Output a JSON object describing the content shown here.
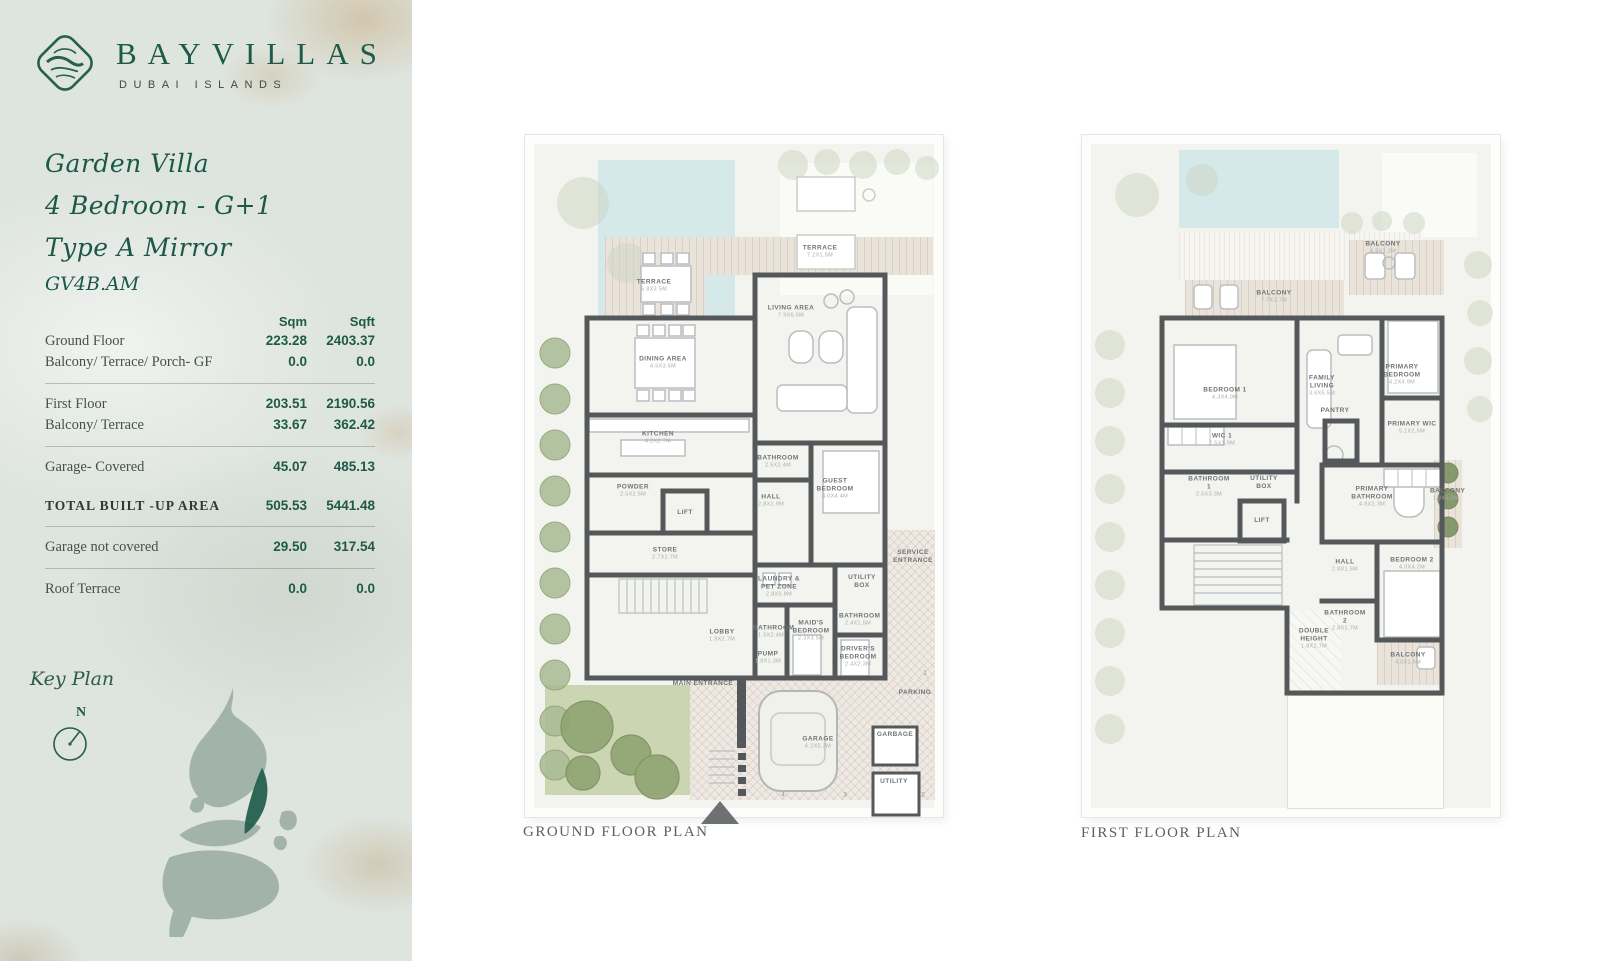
{
  "brand": {
    "name": "BAYVILLAS",
    "tagline": "DUBAI ISLANDS"
  },
  "unit": {
    "title_lines": [
      "Garden Villa",
      "4 Bedroom  -  G+1",
      "Type A Mirror"
    ],
    "code": "GV4B.AM"
  },
  "area_table": {
    "col_headers": [
      "Sqm",
      "Sqft"
    ],
    "rows": [
      {
        "label": "Ground Floor",
        "sqm": "223.28",
        "sqft": "2403.37"
      },
      {
        "label": "Balcony/ Terrace/ Porch- GF",
        "sqm": "0.0",
        "sqft": "0.0"
      },
      {
        "label": "First Floor",
        "sqm": "203.51",
        "sqft": "2190.56"
      },
      {
        "label": "Balcony/ Terrace",
        "sqm": "33.67",
        "sqft": "362.42"
      },
      {
        "label": "Garage- Covered",
        "sqm": "45.07",
        "sqft": "485.13"
      },
      {
        "label": "TOTAL BUILT -UP AREA",
        "sqm": "505.53",
        "sqft": "5441.48"
      },
      {
        "label": "Garage not covered",
        "sqm": "29.50",
        "sqft": "317.54"
      },
      {
        "label": "Roof Terrace",
        "sqm": "0.0",
        "sqft": "0.0"
      }
    ]
  },
  "key_plan": {
    "label": "Key Plan",
    "north": "N"
  },
  "colors": {
    "accent_green": "#1d5a49",
    "map_highlight": "#25604e",
    "pool": "#d5e8ea"
  },
  "plans": {
    "ground": {
      "caption": "GROUND FLOOR PLAN",
      "rooms": [
        {
          "name": "TERRACE",
          "dims": "7.2X1.5M"
        },
        {
          "name": "TERRACE",
          "dims": "5.8X3.5M"
        },
        {
          "name": "LIVING AREA",
          "dims": "7.9X6.6M"
        },
        {
          "name": "DINING AREA",
          "dims": "4.5X3.5M"
        },
        {
          "name": "KITCHEN",
          "dims": "4.2X2.7M"
        },
        {
          "name": "POWDER",
          "dims": "2.5X2.5M"
        },
        {
          "name": "LIFT",
          "dims": ""
        },
        {
          "name": "STORE",
          "dims": "2.7X1.7M"
        },
        {
          "name": "BATHROOM",
          "dims": "2.5X2.4M"
        },
        {
          "name": "HALL",
          "dims": "2.8X1.9M"
        },
        {
          "name": "GUEST BEDROOM",
          "dims": "4.0X4.4M"
        },
        {
          "name": "LAUNDRY & PET ZONE",
          "dims": "2.8X0.8M"
        },
        {
          "name": "BATHROOM",
          "dims": "1.5X2.4M"
        },
        {
          "name": "MAID'S BEDROOM",
          "dims": "2.3X3.5M"
        },
        {
          "name": "UTILITY BOX",
          "dims": ""
        },
        {
          "name": "BATHROOM",
          "dims": "2.4X1.5M"
        },
        {
          "name": "DRIVER'S BEDROOM",
          "dims": "2.4X2.3M"
        },
        {
          "name": "LOBBY",
          "dims": "1.9X2.7M"
        },
        {
          "name": "PUMP",
          "dims": "1.8X1.3M"
        },
        {
          "name": "SERVICE ENTRANCE",
          "dims": ""
        },
        {
          "name": "MAIN ENTRANCE",
          "dims": ""
        },
        {
          "name": "GARAGE",
          "dims": "6.2X5.3M"
        },
        {
          "name": "GARBAGE",
          "dims": ""
        },
        {
          "name": "UTILITY",
          "dims": ""
        },
        {
          "name": "PARKING",
          "dims": ""
        }
      ],
      "parking_numbers": [
        "1",
        "2",
        "3",
        "4"
      ]
    },
    "first": {
      "caption": "FIRST FLOOR PLAN",
      "rooms": [
        {
          "name": "BALCONY",
          "dims": "4.5X1.2M"
        },
        {
          "name": "BALCONY",
          "dims": "7.7X1.7M"
        },
        {
          "name": "BEDROOM 1",
          "dims": "4.3X4.0M"
        },
        {
          "name": "FAMILY LIVING",
          "dims": "3.6X5.5M"
        },
        {
          "name": "PRIMARY BEDROOM",
          "dims": "4.2X4.9M"
        },
        {
          "name": "WIC 1",
          "dims": "2.5X1.5M"
        },
        {
          "name": "PANTRY",
          "dims": ""
        },
        {
          "name": "PRIMARY WIC",
          "dims": "5.1X2.5M"
        },
        {
          "name": "BATHROOM 1",
          "dims": "2.5X3.3M"
        },
        {
          "name": "UTILITY BOX",
          "dims": ""
        },
        {
          "name": "LIFT",
          "dims": ""
        },
        {
          "name": "PRIMARY BATHROOM",
          "dims": "4.8X2.3M"
        },
        {
          "name": "BALCONY",
          "dims": "1.0X3.0M"
        },
        {
          "name": "HALL",
          "dims": "2.8X1.5M"
        },
        {
          "name": "BEDROOM 2",
          "dims": "4.0X4.2M"
        },
        {
          "name": "BATHROOM 2",
          "dims": "2.8X1.7M"
        },
        {
          "name": "DOUBLE HEIGHT",
          "dims": "1.8X2.7M"
        },
        {
          "name": "BALCONY",
          "dims": "4.0X1.6M"
        }
      ]
    }
  }
}
